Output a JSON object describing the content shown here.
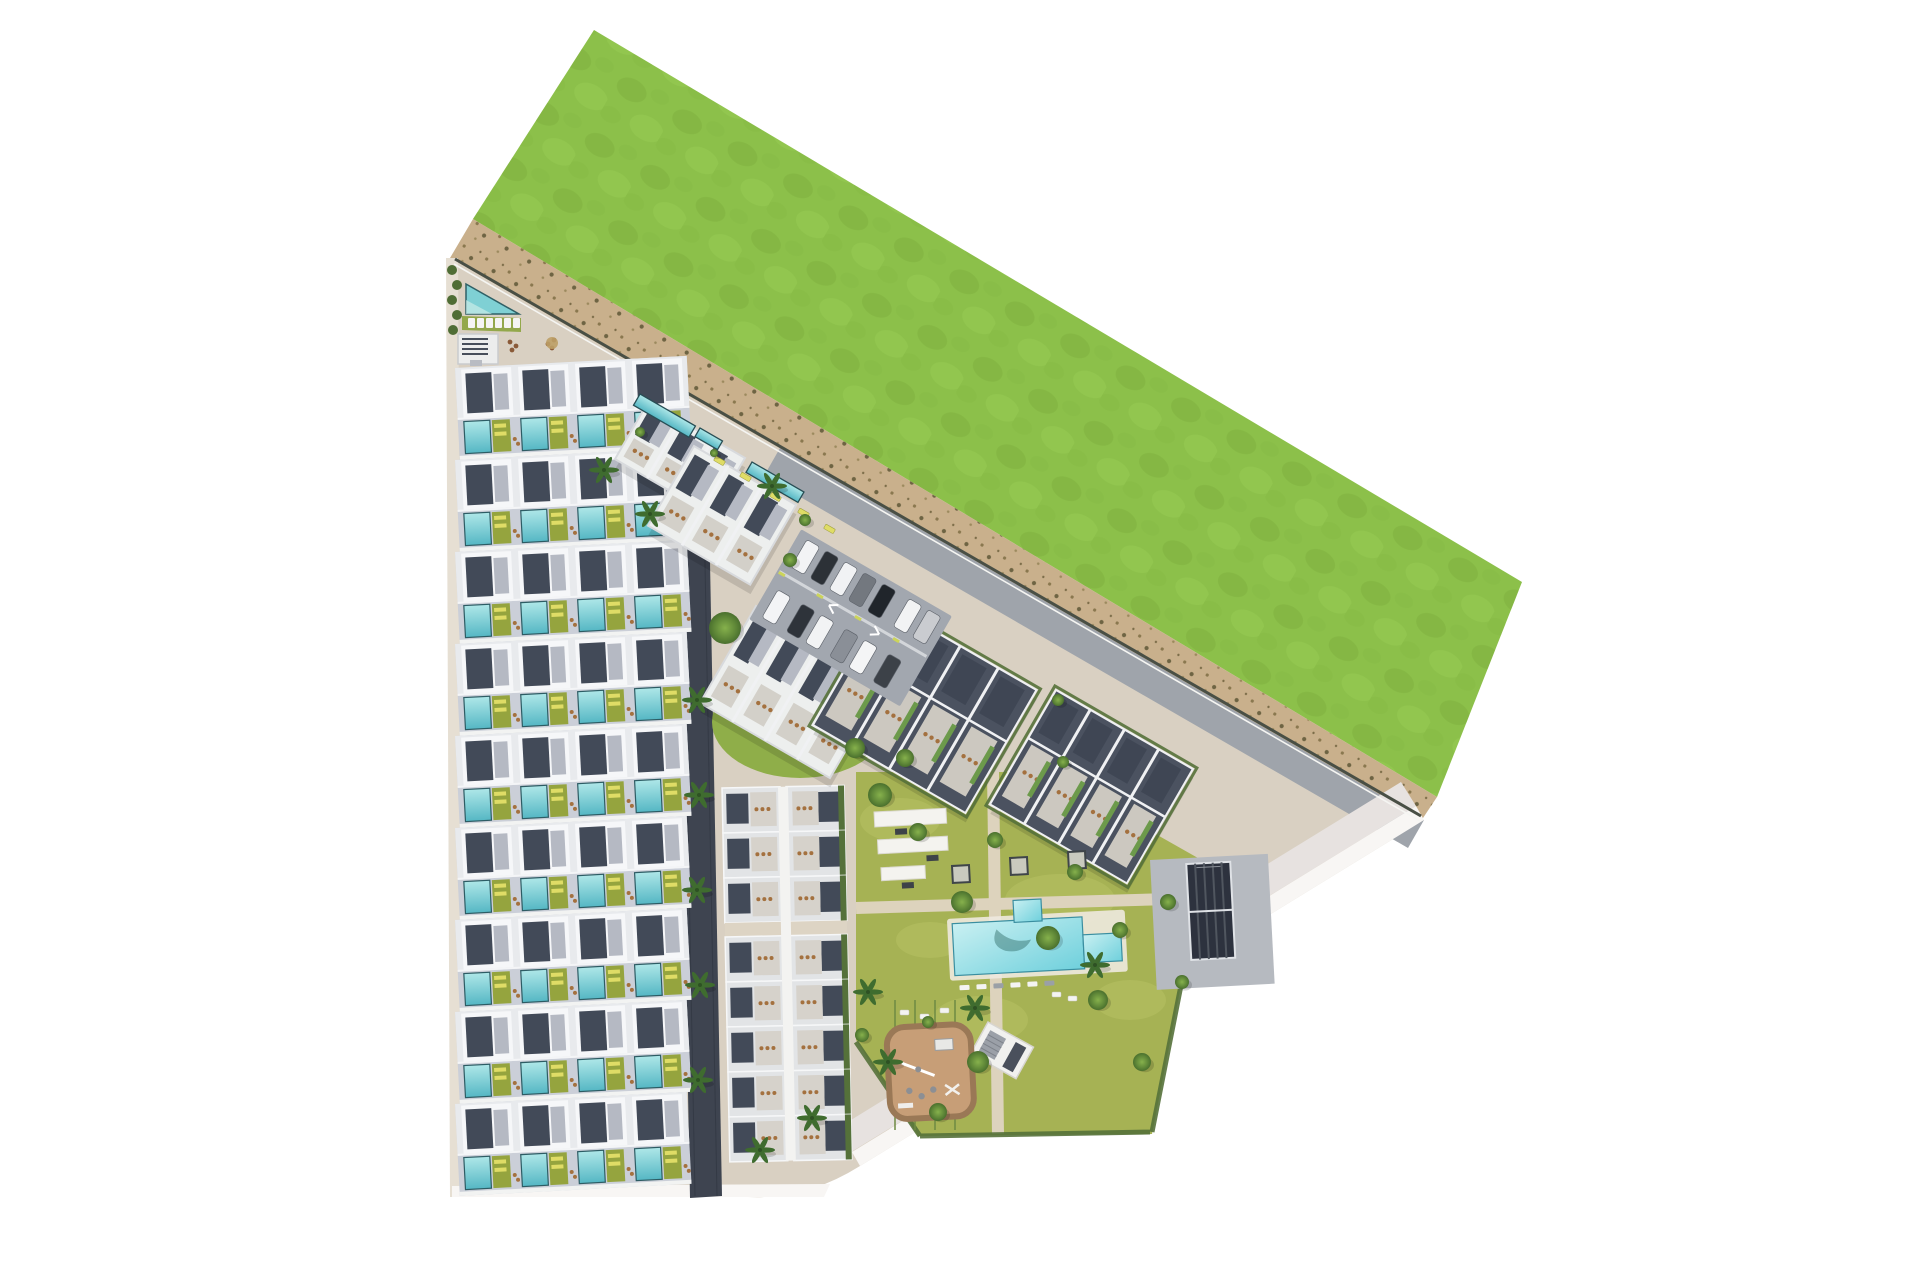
{
  "scene": {
    "width": 1920,
    "height": 1280,
    "background": "#ffffff",
    "description": "Aerial top-down 3D site plan of a coastal residential development: green field, sand buffer, townhouse rows with private pools, tilted apartment blocks, parking, communal pool garden, playground and padel court."
  },
  "colors": {
    "grass": "#8cc04a",
    "grassDark": "#7cae3c",
    "grassLight": "#9ccf57",
    "sand": "#c9b08c",
    "sandDot": "#8a784f",
    "devBase": "#d9d0c2",
    "plaza": "#d8cbb4",
    "roadDark": "#3e4450",
    "roadGray": "#9fa4ab",
    "seRoad": "#e7e2e0",
    "sidewalk": "#f8f6f4",
    "westWalk": "#e6dfd3",
    "roofSlate": "#424a58",
    "roofWhite": "#f6f7f9",
    "roofGray": "#b5b9c3",
    "blockLight": "#edefee",
    "blockDark": "#4b5260",
    "parapet": "#f0f1f3",
    "terraceOlive": "#95a43e",
    "terraceGray": "#ccc8c0",
    "loungerYellow": "#dfdc66",
    "furnitureTan": "#a4713f",
    "poolTealTop": "#aee7e8",
    "poolTealBottom": "#55b7c4",
    "poolEdge": "#2d5c64",
    "poolBlueTop": "#c9f0f2",
    "poolBlueBottom": "#6fd0dc",
    "lawn": "#a6b254",
    "lawnLight": "#b7c162",
    "hedge": "#55713a",
    "fence": "#6e8a43",
    "treeCore": "#7fa846",
    "treeEdge": "#4e7531",
    "palm": "#3f6c2f",
    "playground": "#c79e77",
    "playBorder": "#9a7856",
    "asphalt": "#a2a7af",
    "carWhite": "#f2f3f5",
    "carDark": "#2c3137",
    "carGray": "#73787f",
    "court": "#2d323e",
    "courtLine": "#dfe2e6",
    "wall": "#494f45",
    "white": "#ffffff",
    "canopy": "#f4f3ef"
  },
  "site": {
    "green": "594,30 1522,582 1437,797 473,219",
    "sand": "473,219 1437,797 1421,821 450,258",
    "dev_path": "M450,258 L1424,820 L860,1166 Q806,1200 748,1197 L452,1197 Z",
    "se_sidewalk": "1424,820 860,1166 852,1152 1416,806",
    "se_road": "1416,806 851,1152 838,1128 1401,782",
    "bottom_sidewalk": "452,1186 830,1184 824,1197 452,1197",
    "west_sidewalk": "446,258 458,258 464,1197 450,1197",
    "ne_road": "780,448 1424,820 1408,848 764,476",
    "wall": {
      "x1": 455,
      "y1": 259,
      "x2": 1421,
      "y2": 816
    },
    "dark_road": "676,458 708,456 722,1196 690,1198",
    "lawn": "856,772 1046,772 1205,862 1152,1134 918,1136 856,1040",
    "lawn_paths": [
      "M856,908 L1205,898",
      "M993,772 L998,1134"
    ],
    "lawn_patch_a": {
      "cx": 800,
      "cy": 722,
      "rx": 88,
      "ry": 56
    }
  },
  "townhouses": {
    "rows": 9,
    "x": 455,
    "top": 368,
    "pitch": 92,
    "row_w": 232,
    "row_h": 92,
    "tilt": -3,
    "units_per_row": 4
  },
  "d_strip": {
    "x": 722,
    "y": 788,
    "tilt": -1.2,
    "w": 122,
    "row_h": 45,
    "rows_top": 3,
    "rows_bottom": 5,
    "gap": 14
  },
  "blocks": [
    {
      "name": "block-t1",
      "x": 648,
      "y": 402,
      "w": 112,
      "h": 66,
      "angle": 30,
      "style": "light",
      "units": 3
    },
    {
      "name": "block-t2",
      "x": 694,
      "y": 446,
      "w": 118,
      "h": 92,
      "angle": 30,
      "style": "light",
      "units": 3
    },
    {
      "name": "block-a",
      "x": 756,
      "y": 606,
      "w": 150,
      "h": 112,
      "angle": 30,
      "style": "light",
      "units": 4
    },
    {
      "name": "block-b",
      "x": 884,
      "y": 602,
      "w": 176,
      "h": 142,
      "angle": 30,
      "style": "dark",
      "units": 4
    },
    {
      "name": "block-c",
      "x": 1056,
      "y": 690,
      "w": 158,
      "h": 132,
      "angle": 30,
      "style": "dark",
      "units": 4
    }
  ],
  "lap_pools": [
    {
      "x": 640,
      "y": 394,
      "w": 64,
      "h": 13
    },
    {
      "x": 752,
      "y": 462,
      "w": 60,
      "h": 12
    },
    {
      "x": 700,
      "y": 428,
      "w": 26,
      "h": 10
    }
  ],
  "ne_loungers": [
    [
      716,
      456
    ],
    [
      742,
      472
    ],
    [
      772,
      492
    ],
    [
      800,
      508
    ],
    [
      826,
      524
    ]
  ],
  "corner_amenity": {
    "pool_points": "466,284 519,314 466,314",
    "lawn_points": "462,316 521,318 521,332 462,330",
    "lounger_start_x": 468,
    "lounger_y": 318,
    "lounger_step": 9,
    "lounger_count": 6,
    "structure": {
      "x": 458,
      "y": 334,
      "w": 40,
      "h": 30
    },
    "hedge_dots": [
      [
        452,
        270
      ],
      [
        457,
        285
      ],
      [
        452,
        300
      ],
      [
        457,
        315
      ],
      [
        453,
        330
      ]
    ],
    "seating_dots": [
      [
        510,
        342
      ],
      [
        516,
        346
      ],
      [
        512,
        350
      ],
      [
        548,
        344
      ],
      [
        554,
        340
      ],
      [
        552,
        348
      ]
    ]
  },
  "parking": {
    "x": 802,
    "y": 532,
    "angle": 30,
    "w": 170,
    "h": 100,
    "cars_row1": [
      [
        8,
        "#f2f3f5"
      ],
      [
        30,
        "#2c3137"
      ],
      [
        52,
        "#f1f2f4"
      ],
      [
        74,
        "#73787f"
      ],
      [
        96,
        "#20252b"
      ],
      [
        126,
        "#f2f3f4"
      ],
      [
        148,
        "#caccd0"
      ]
    ],
    "cars_row2": [
      [
        8,
        "#f3f4f6"
      ],
      [
        36,
        "#2e333a"
      ],
      [
        58,
        "#f2f3f4"
      ],
      [
        86,
        "#8a8f97"
      ],
      [
        108,
        "#f4f5f6"
      ],
      [
        136,
        "#3c4148"
      ]
    ],
    "dash_xs": [
      0,
      44,
      88,
      132
    ]
  },
  "padel": {
    "x": 1150,
    "y": 860,
    "angle": -3,
    "apron_w": 118,
    "apron_h": 130,
    "court": {
      "x": 36,
      "y": 6,
      "w": 44,
      "h": 96
    },
    "stripes": 4
  },
  "pool_house": {
    "x": 988,
    "y": 1022,
    "angle": 29,
    "w": 52,
    "h": 36
  },
  "playground": {
    "x": 886,
    "y": 1028,
    "angle": -3,
    "w": 84,
    "h": 92
  },
  "pool": {
    "x": 945,
    "y": 902,
    "angle": -3,
    "main": [
      6,
      22,
      130,
      52
    ],
    "top_tab": [
      68,
      2,
      28,
      22
    ],
    "right_tab": [
      136,
      40,
      38,
      28
    ],
    "lounger_row_y": 84,
    "lounger_count": 6
  },
  "canopies": {
    "x": 874,
    "y": 812,
    "angle": -3,
    "bars": [
      [
        0,
        0,
        72,
        15
      ],
      [
        2,
        28,
        70,
        14
      ],
      [
        4,
        56,
        44,
        13
      ]
    ],
    "benches": [
      [
        20,
        18
      ],
      [
        50,
        46
      ],
      [
        24,
        72
      ]
    ]
  },
  "cabanas": [
    [
      952,
      866
    ],
    [
      1010,
      858
    ],
    [
      1068,
      852
    ]
  ],
  "garden_fences": {
    "x_start": 895,
    "x_step": 20,
    "count": 4,
    "y1": 1000,
    "y2": 1130
  },
  "garden_loungers": [
    [
      900,
      1010
    ],
    [
      920,
      1014
    ],
    [
      940,
      1008
    ],
    [
      902,
      1060
    ],
    [
      924,
      1064
    ],
    [
      902,
      1110
    ],
    [
      926,
      1112
    ],
    [
      1052,
      992
    ],
    [
      1068,
      996
    ]
  ],
  "trees": [
    [
      725,
      628,
      16
    ],
    [
      805,
      520,
      6
    ],
    [
      790,
      560,
      7
    ],
    [
      880,
      795,
      12
    ],
    [
      918,
      832,
      9
    ],
    [
      962,
      902,
      11
    ],
    [
      1048,
      938,
      12
    ],
    [
      1098,
      1000,
      10
    ],
    [
      978,
      1062,
      11
    ],
    [
      938,
      1112,
      9
    ],
    [
      1142,
      1062,
      9
    ],
    [
      1075,
      872,
      8
    ],
    [
      1168,
      902,
      8
    ],
    [
      862,
      1035,
      7
    ],
    [
      928,
      1022,
      6
    ],
    [
      1058,
      700,
      6
    ],
    [
      1063,
      762,
      6
    ],
    [
      640,
      432,
      5
    ],
    [
      714,
      453,
      4
    ],
    [
      1182,
      982,
      7
    ],
    [
      905,
      758,
      9
    ],
    [
      855,
      748,
      10
    ],
    [
      995,
      840,
      8
    ],
    [
      1120,
      930,
      8
    ]
  ],
  "palms": [
    [
      604,
      470
    ],
    [
      650,
      514
    ],
    [
      697,
      700
    ],
    [
      699,
      795
    ],
    [
      697,
      890
    ],
    [
      700,
      985
    ],
    [
      698,
      1080
    ],
    [
      760,
      1150
    ],
    [
      812,
      1118
    ],
    [
      888,
      1062
    ],
    [
      868,
      992
    ],
    [
      975,
      1008
    ],
    [
      1095,
      965
    ],
    [
      772,
      486
    ]
  ]
}
